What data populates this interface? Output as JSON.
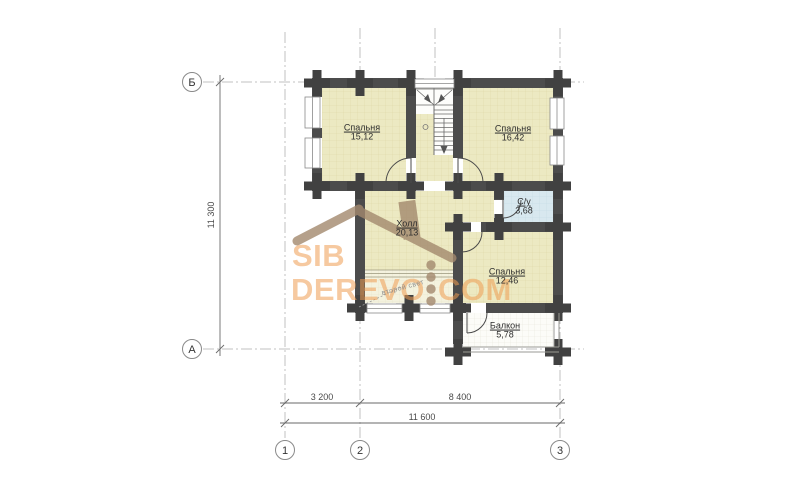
{
  "drawing": {
    "kind": "floor-plan",
    "style": "log-house plan with axis grid and dimensions"
  },
  "watermark": {
    "line1": "SIB",
    "line2": "DEREVO",
    "line3": "COM"
  },
  "rooms": [
    {
      "name": "Спальня",
      "area": "15,12"
    },
    {
      "name": "Спальня",
      "area": "16,42"
    },
    {
      "name": "С/у",
      "area": "3,68"
    },
    {
      "name": "Холл",
      "area": "20,13"
    },
    {
      "name": "Спальня",
      "area": "12,46"
    },
    {
      "name": "Балкон",
      "area": "5,78"
    }
  ],
  "axes": {
    "row_top": "Б",
    "row_bottom": "А",
    "col_1": "1",
    "col_2": "2",
    "col_3": "3"
  },
  "dimensions": {
    "vertical_total": "11 300",
    "bottom_left": "3 200",
    "bottom_right": "8 400",
    "bottom_total": "11 600"
  },
  "annotations": {
    "second_light": "второй свет"
  },
  "palette": {
    "wall": "#4c4c4c",
    "log_joint": "#414141",
    "room_fill": "#ece9c2",
    "second_light_fill": "#f4f2de",
    "bathroom_fill": "#d8e8ef",
    "balcony_fill": "#fcfcf8",
    "watermark_orange": "#ee9c52",
    "watermark_brown": "#a3896e",
    "axis_line": "#c2c2c2",
    "dimension_line": "#6a6a6a"
  }
}
